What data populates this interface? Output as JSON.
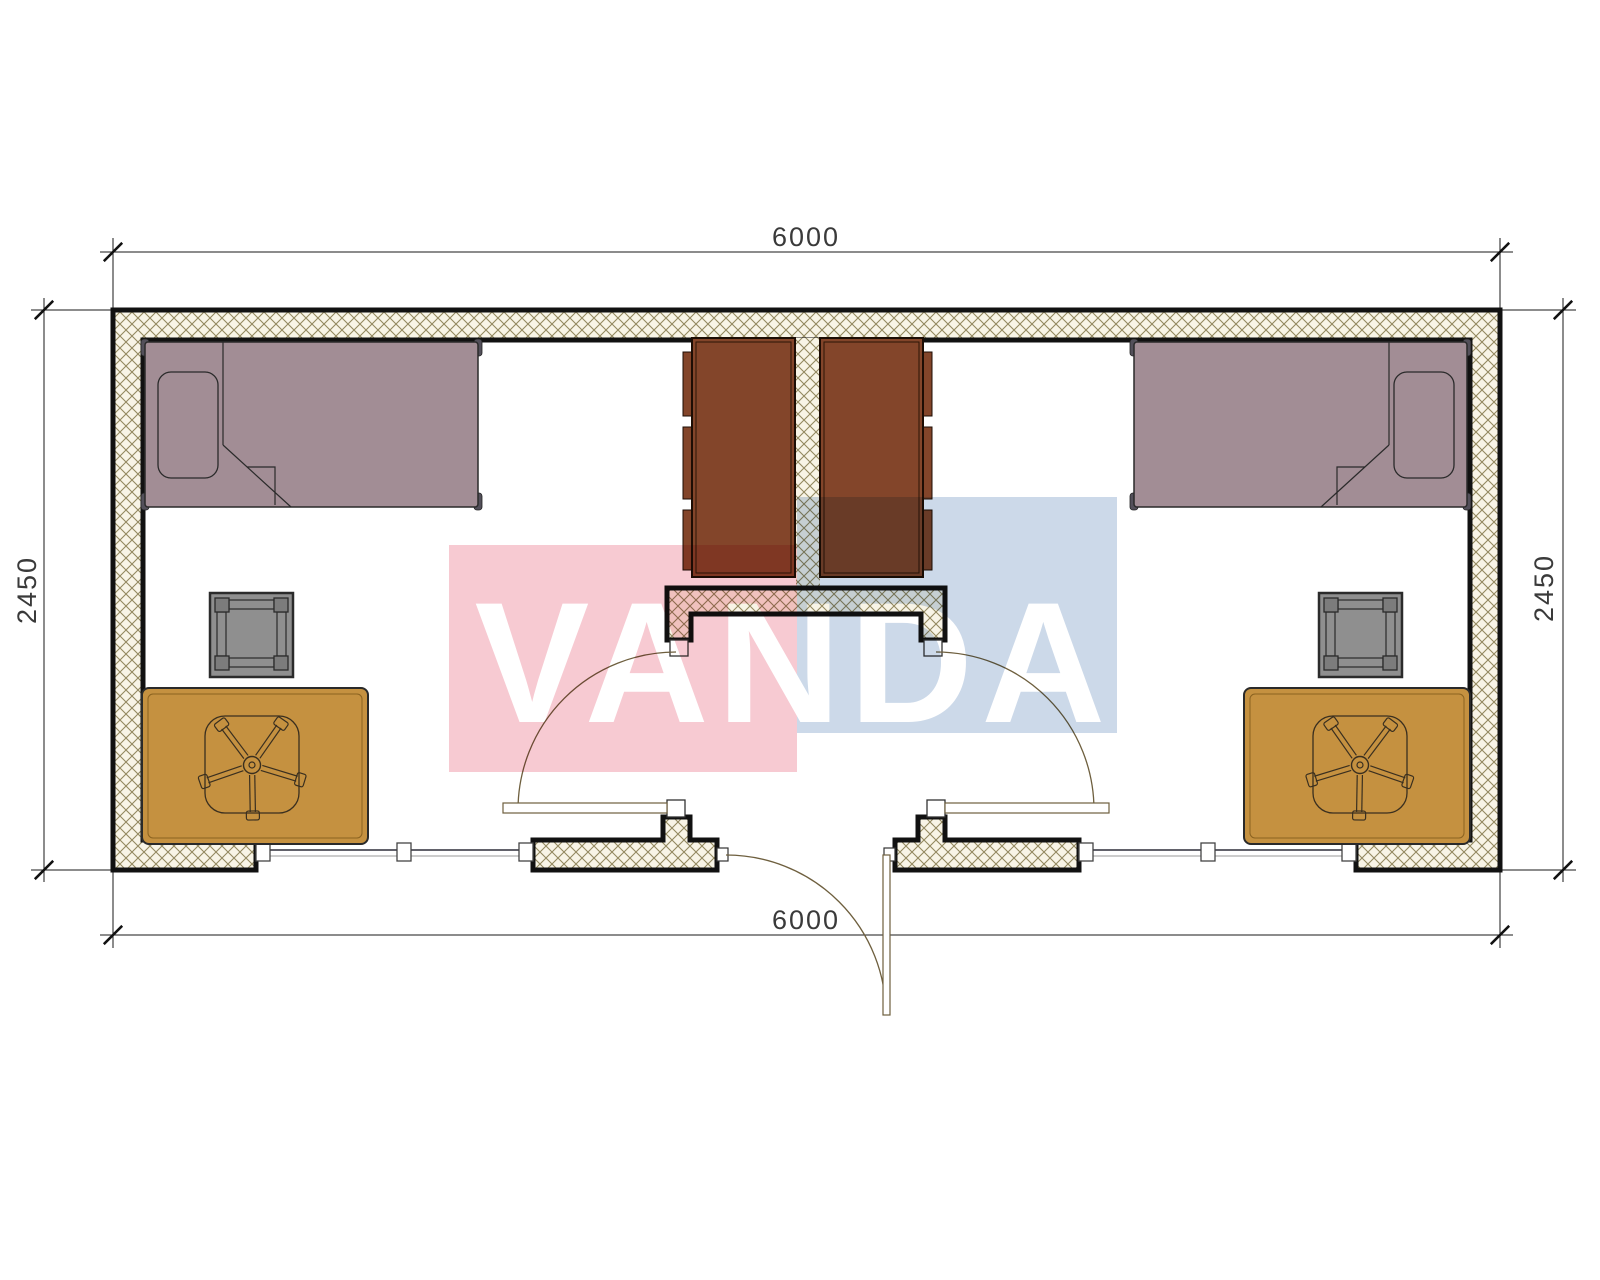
{
  "title": "Two-room cabin floor plan",
  "dimensions": {
    "top": "6000",
    "bottom": "6000",
    "left": "2450",
    "right": "2450"
  },
  "watermark": {
    "text": "VANDA",
    "pink_color": "#f7cad2",
    "blue_color": "#ccd9e9",
    "text_color": "#ffffff"
  },
  "colors": {
    "bed": "#a28d95",
    "bed_post": "#53505a",
    "wardrobe": "#83452a",
    "desk": "#c59140",
    "stool": "#8f8f8f",
    "stool_pad": "#7c7c7c",
    "wall_line": "#111111",
    "hatch_bg": "#f8f4e6",
    "hatch_line": "#93885f",
    "door_line": "#6e5f3e",
    "dim_line": "#1a1a1a",
    "dim_text_color": "#3a3a3a"
  }
}
